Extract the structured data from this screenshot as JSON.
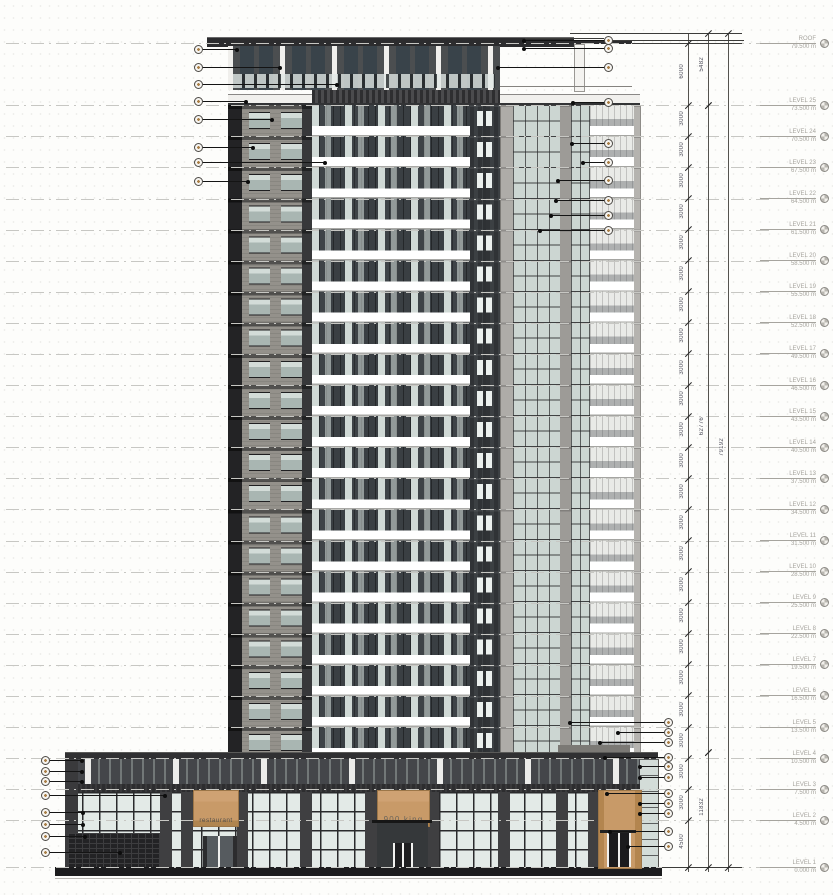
{
  "drawing": {
    "type_label": "building elevation"
  },
  "signs": {
    "restaurant": "restaurant",
    "shop": "900 king"
  },
  "colors": {
    "tan_accent": "#c89a68",
    "dark_cladding": "#2e2e30",
    "brick_grey": "#94918b",
    "glazing_light": "#d6dfdb",
    "balcony_slab": "#ffffff",
    "annotation_line": "#141414",
    "level_text": "#a6a49e",
    "dim_text": "#50505c"
  },
  "levels": [
    {
      "name": "ROOF",
      "elevation_label": "79.500 m",
      "elevation_m": 79.5
    },
    {
      "name": "LEVEL 25",
      "elevation_label": "73.500 m",
      "elevation_m": 73.5
    },
    {
      "name": "LEVEL 24",
      "elevation_label": "70.500 m",
      "elevation_m": 70.5
    },
    {
      "name": "LEVEL 23",
      "elevation_label": "67.500 m",
      "elevation_m": 67.5
    },
    {
      "name": "LEVEL 22",
      "elevation_label": "64.500 m",
      "elevation_m": 64.5
    },
    {
      "name": "LEVEL 21",
      "elevation_label": "61.500 m",
      "elevation_m": 61.5
    },
    {
      "name": "LEVEL 20",
      "elevation_label": "58.500 m",
      "elevation_m": 58.5
    },
    {
      "name": "LEVEL 19",
      "elevation_label": "55.500 m",
      "elevation_m": 55.5
    },
    {
      "name": "LEVEL 18",
      "elevation_label": "52.500 m",
      "elevation_m": 52.5
    },
    {
      "name": "LEVEL 17",
      "elevation_label": "49.500 m",
      "elevation_m": 49.5
    },
    {
      "name": "LEVEL 16",
      "elevation_label": "46.500 m",
      "elevation_m": 46.5
    },
    {
      "name": "LEVEL 15",
      "elevation_label": "43.500 m",
      "elevation_m": 43.5
    },
    {
      "name": "LEVEL 14",
      "elevation_label": "40.500 m",
      "elevation_m": 40.5
    },
    {
      "name": "LEVEL 13",
      "elevation_label": "37.500 m",
      "elevation_m": 37.5
    },
    {
      "name": "LEVEL 12",
      "elevation_label": "34.500 m",
      "elevation_m": 34.5
    },
    {
      "name": "LEVEL 11",
      "elevation_label": "31.500 m",
      "elevation_m": 31.5
    },
    {
      "name": "LEVEL 10",
      "elevation_label": "28.500 m",
      "elevation_m": 28.5
    },
    {
      "name": "LEVEL 9",
      "elevation_label": "25.500 m",
      "elevation_m": 25.5
    },
    {
      "name": "LEVEL 8",
      "elevation_label": "22.500 m",
      "elevation_m": 22.5
    },
    {
      "name": "LEVEL 7",
      "elevation_label": "19.500 m",
      "elevation_m": 19.5
    },
    {
      "name": "LEVEL 6",
      "elevation_label": "16.500 m",
      "elevation_m": 16.5
    },
    {
      "name": "LEVEL 5",
      "elevation_label": "13.500 m",
      "elevation_m": 13.5
    },
    {
      "name": "LEVEL 4",
      "elevation_label": "10.500 m",
      "elevation_m": 10.5
    },
    {
      "name": "LEVEL 3",
      "elevation_label": "7.500 m",
      "elevation_m": 7.5
    },
    {
      "name": "LEVEL 2",
      "elevation_label": "4.500 m",
      "elevation_m": 4.5
    },
    {
      "name": "LEVEL 1",
      "elevation_label": "0.000 m",
      "elevation_m": 0.0
    }
  ],
  "dimensions": {
    "floor_dims": [
      "6000",
      "3000",
      "3000",
      "3000",
      "3000",
      "3000",
      "3000",
      "3000",
      "3000",
      "3000",
      "3000",
      "3000",
      "3000",
      "3000",
      "3000",
      "3000",
      "3000",
      "3000",
      "3000",
      "3000",
      "3000",
      "3000",
      "3000",
      "3000",
      "4500"
    ],
    "span_dims": [
      {
        "label": "5482",
        "line": "B",
        "y1": 33,
        "y2": 105
      },
      {
        "label": "62776",
        "line": "B",
        "y1": 105,
        "y2": 752
      },
      {
        "label": "11832",
        "line": "B",
        "y1": 752,
        "y2": 867
      },
      {
        "label": "79192",
        "line": "C",
        "y1": 33,
        "y2": 867
      }
    ],
    "extension_lines": [
      {
        "y": 33,
        "x1": 570,
        "x2": 742
      },
      {
        "y": 38,
        "x1": 525,
        "x2": 604
      },
      {
        "y": 40,
        "x1": 612,
        "x2": 744
      },
      {
        "y": 43,
        "x1": 632,
        "x2": 742
      },
      {
        "y": 867,
        "x1": 662,
        "x2": 742
      }
    ]
  },
  "callouts": {
    "left_top": {
      "cx": 198,
      "side": "left",
      "items": [
        {
          "label": "",
          "y": 49,
          "dx": 237
        },
        {
          "label": "",
          "y": 67,
          "dx": 280
        },
        {
          "label": "",
          "y": 84,
          "dx": 337
        },
        {
          "label": "",
          "y": 101,
          "dx": 246
        },
        {
          "label": "",
          "y": 119,
          "dx": 272
        },
        {
          "label": "",
          "y": 147,
          "dx": 253
        },
        {
          "label": "",
          "y": 162,
          "dx": 325
        },
        {
          "label": "",
          "y": 181,
          "dx": 248
        }
      ]
    },
    "right_roof": {
      "cx": 608,
      "side": "right",
      "items": [
        {
          "label": "",
          "y": 40,
          "dx": 524
        },
        {
          "label": "",
          "y": 48,
          "dx": 524
        },
        {
          "label": "",
          "y": 67,
          "dx": 498
        },
        {
          "label": "",
          "y": 102,
          "dx": 573
        }
      ]
    },
    "right_mid": {
      "cx": 608,
      "side": "right",
      "items": [
        {
          "label": "",
          "y": 143,
          "dx": 572
        },
        {
          "label": "",
          "y": 162,
          "dx": 583
        },
        {
          "label": "",
          "y": 180,
          "dx": 558
        },
        {
          "label": "",
          "y": 200,
          "dx": 556
        },
        {
          "label": "",
          "y": 215,
          "dx": 551
        },
        {
          "label": "",
          "y": 230,
          "dx": 540
        }
      ]
    },
    "bottom_left": {
      "cx": 45,
      "side": "left",
      "items": [
        {
          "label": "",
          "y": 760,
          "dx": 82
        },
        {
          "label": "",
          "y": 771,
          "dx": 82
        },
        {
          "label": "",
          "y": 781,
          "dx": 82
        },
        {
          "label": "",
          "y": 795,
          "dx": 165
        },
        {
          "label": "",
          "y": 812,
          "dx": 83
        },
        {
          "label": "",
          "y": 824,
          "dx": 83
        },
        {
          "label": "",
          "y": 836,
          "dx": 85
        },
        {
          "label": "",
          "y": 852,
          "dx": 120
        }
      ]
    },
    "bottom_right": {
      "cx": 668,
      "side": "right",
      "items": [
        {
          "label": "",
          "y": 722,
          "dx": 570
        },
        {
          "label": "",
          "y": 732,
          "dx": 618
        },
        {
          "label": "",
          "y": 742,
          "dx": 600
        },
        {
          "label": "",
          "y": 757,
          "dx": 605
        },
        {
          "label": "",
          "y": 766,
          "dx": 640
        },
        {
          "label": "",
          "y": 777,
          "dx": 640
        },
        {
          "label": "",
          "y": 793,
          "dx": 607
        },
        {
          "label": "",
          "y": 803,
          "dx": 640
        },
        {
          "label": "",
          "y": 813,
          "dx": 640
        },
        {
          "label": "",
          "y": 831,
          "dx": 610
        },
        {
          "label": "",
          "y": 846,
          "dx": 628
        }
      ]
    }
  },
  "geometry": {
    "ground_y": 867,
    "px_per_m": 10.364,
    "dim_line_x": {
      "A": 688,
      "B": 708,
      "C": 728
    }
  }
}
